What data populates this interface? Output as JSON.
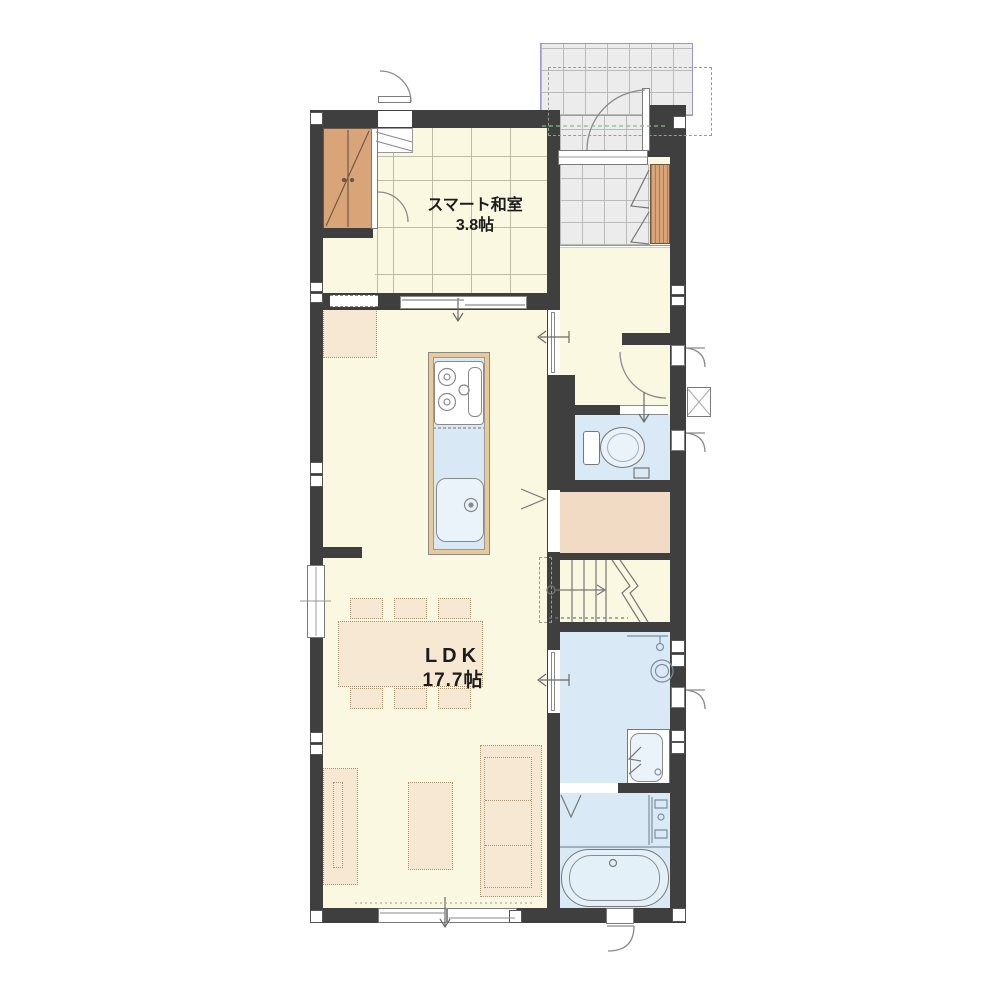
{
  "plan": {
    "type": "floor-plan-1F",
    "rooms": {
      "japanese_room": {
        "label": "スマート和室",
        "size": "3.8帖"
      },
      "ldk": {
        "label": "LDK",
        "size": "17.7帖"
      }
    },
    "features": [
      "entrance-porch",
      "genkan",
      "shoe-cabinet",
      "closet",
      "hall",
      "toilet",
      "storage",
      "stairs",
      "washroom",
      "washing-machine",
      "vanity",
      "bathroom",
      "bathtub",
      "kitchen-island",
      "gas-stove",
      "kitchen-sink",
      "dining-table",
      "6-chairs",
      "sofa",
      "coffee-table",
      "tv-board",
      "counter-desk"
    ],
    "colors": {
      "wall": "#3F3F3F",
      "floor": "#FBF8E2",
      "wet_room": "#D9EAF6",
      "tile": "#ECECEC",
      "porch_border": "#9898CC",
      "wood": "#D9A478",
      "storage_floor": "#F2DBC4",
      "furniture": "#F6E8D2",
      "kitchen_counter_edge": "#E9CA96"
    }
  }
}
